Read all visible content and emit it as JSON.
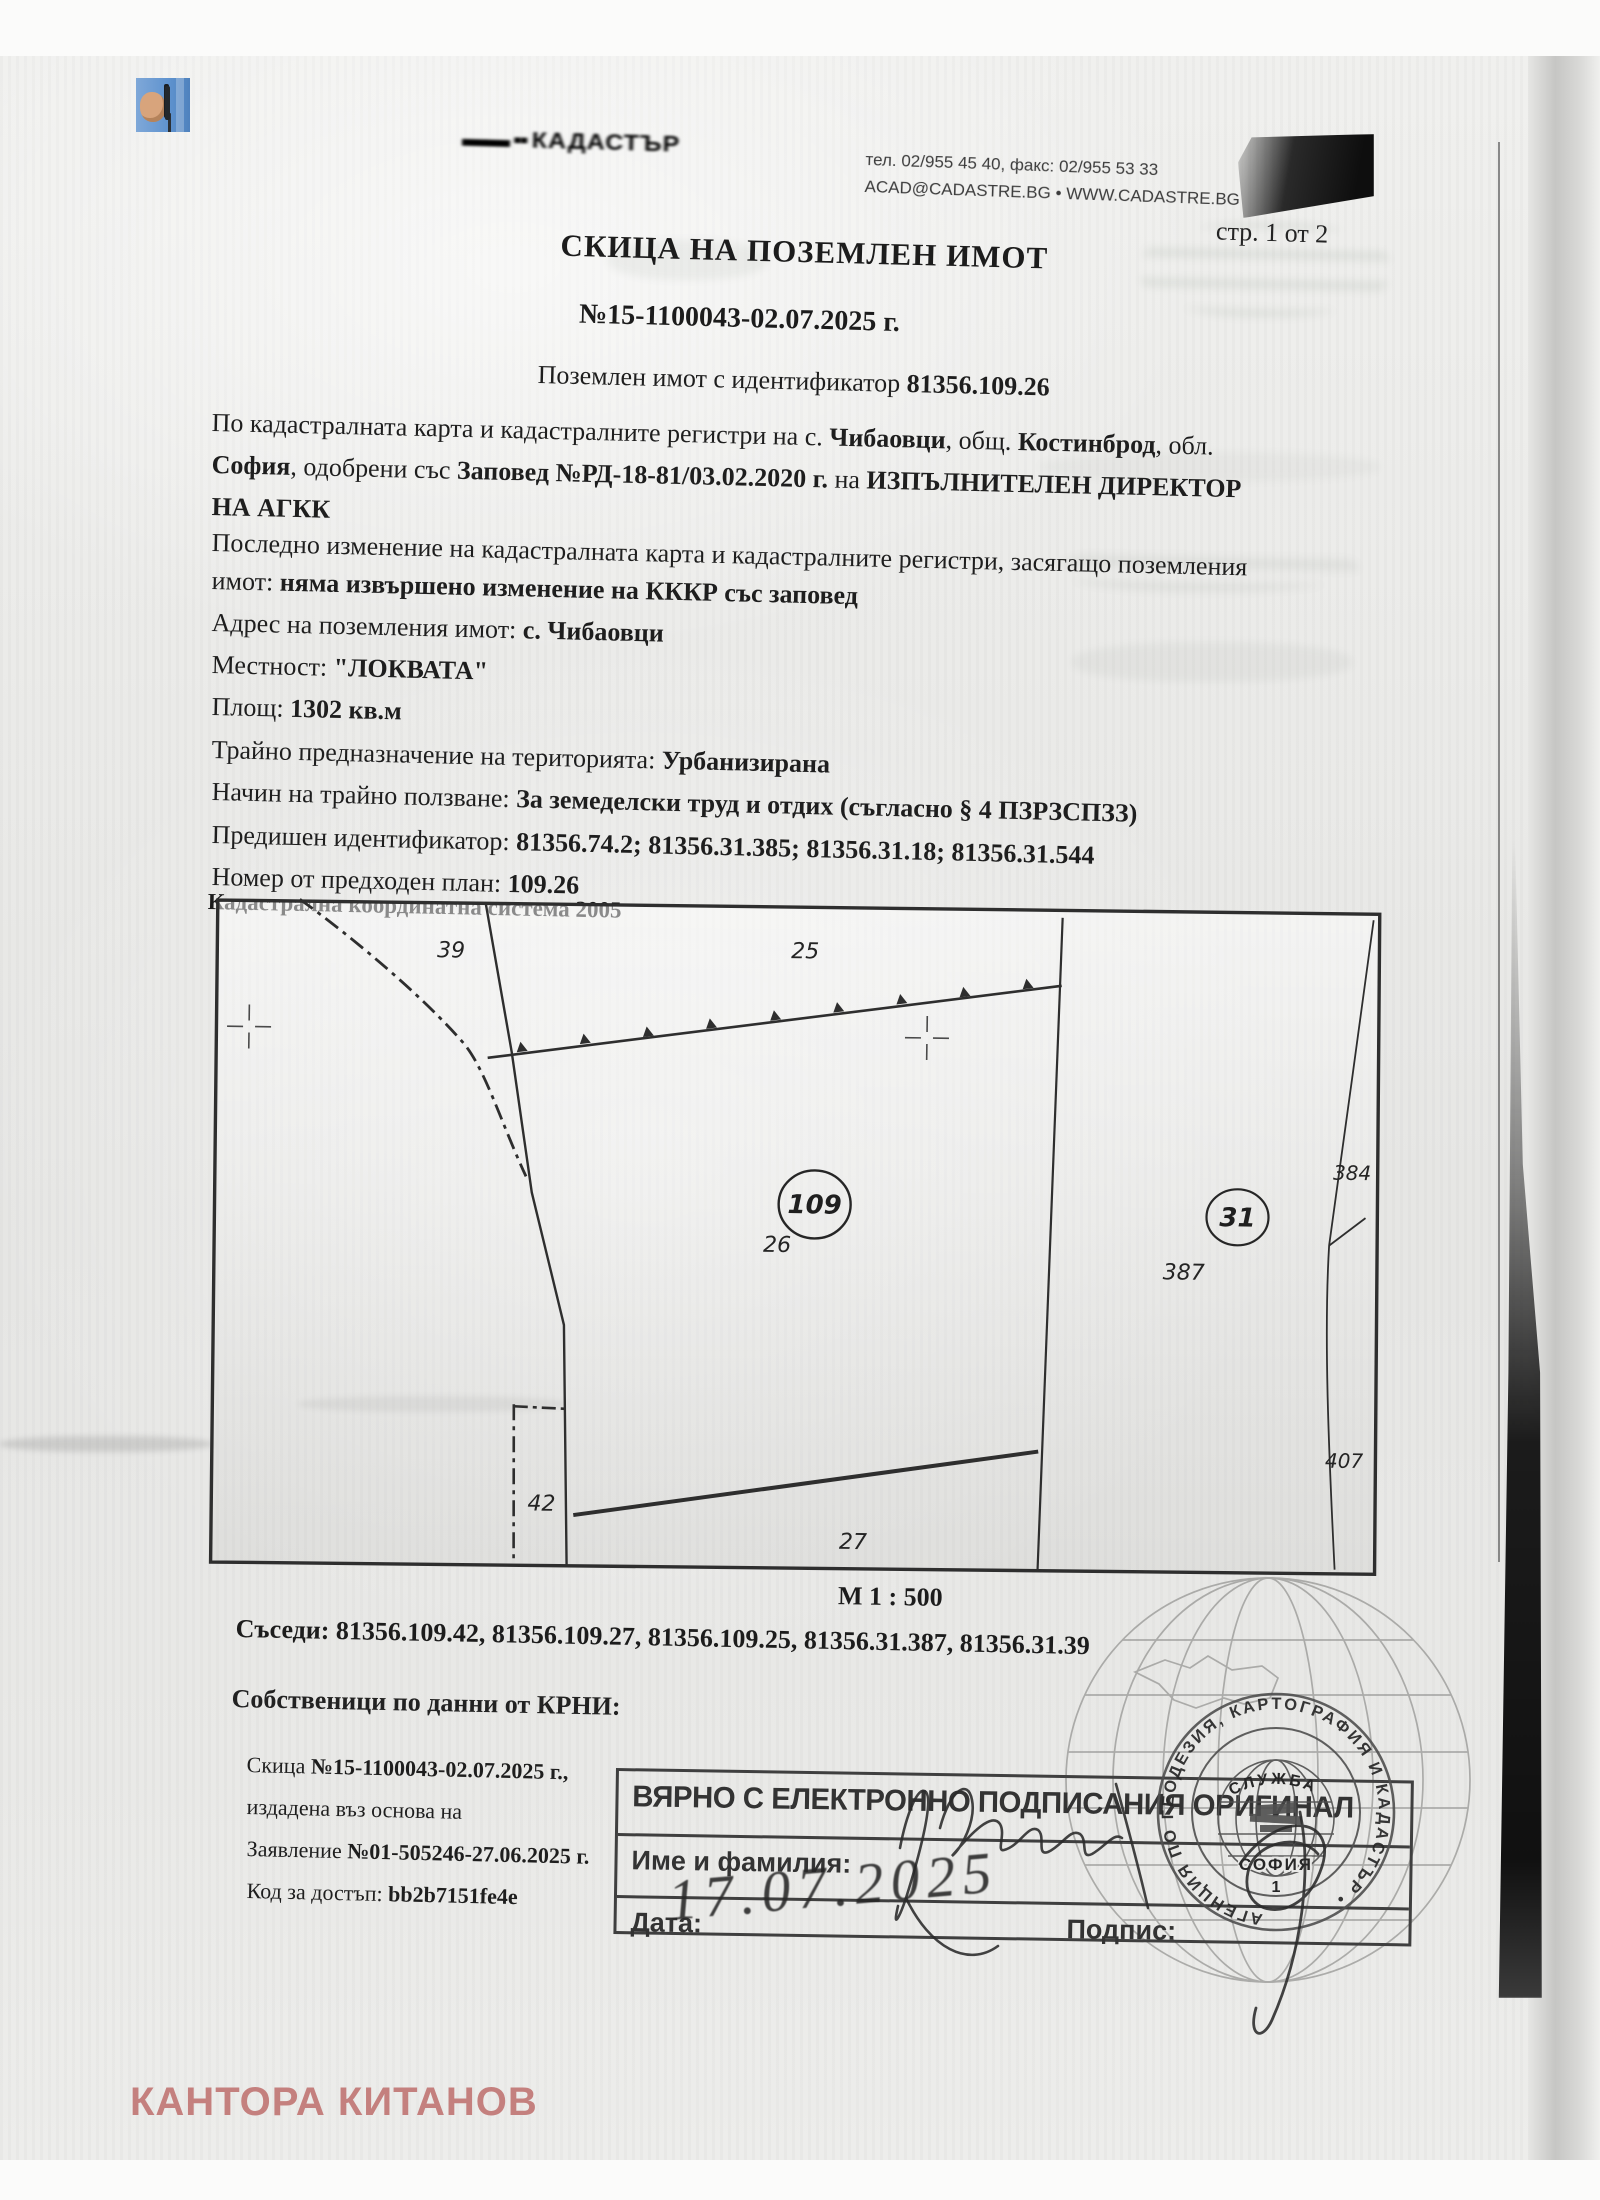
{
  "page": {
    "number_label": "стр. 1 от 2",
    "watermark": "КАНТОРА КИТАНОВ",
    "watermark_color": "#c4807e",
    "accent_ink": "#3f3f3f"
  },
  "header": {
    "smudge_text": "КАДАСТЪР",
    "phone_line": "тел. 02/955 45 40, факс: 02/955 53 33",
    "web_line": "ACAD@CADASTRE.BG • WWW.CADASTRE.BG"
  },
  "title": {
    "main": "СКИЦА НА ПОЗЕМЛЕН ИМОТ",
    "number": "№15-1100043-02.07.2025 г.",
    "id_prefix": "Поземлен имот с идентификатор ",
    "id_value": "81356.109.26"
  },
  "body": {
    "l1": [
      "По кадастралната карта и кадастралните регистри на с. ",
      "Чибаовци",
      ", общ. ",
      "Костинброд",
      ", обл."
    ],
    "l2": [
      "София",
      ", одобрени със ",
      "Заповед №РД-18-81/03.02.2020 г.",
      " на ",
      "ИЗПЪЛНИТЕЛЕН ДИРЕКТОР"
    ],
    "l3": "НА АГКК",
    "l4": "Последно изменение на кадастралната карта и кадастралните регистри, засягащо поземления",
    "l5": [
      "имот: ",
      "няма извършено изменение на КККР със заповед"
    ],
    "l6": [
      "Адрес на поземления имот: ",
      "с. Чибаовци"
    ],
    "l7": [
      "Местност: ",
      "\"ЛОКВАТА\""
    ],
    "l8": [
      "Площ: ",
      "1302 кв.м"
    ],
    "l9": [
      "Трайно предназначение на територията: ",
      "Урбанизирана"
    ],
    "l10": [
      "Начин на трайно ползване: ",
      "За земеделски труд и отдих (съгласно § 4 ПЗРЗСПЗЗ)"
    ],
    "l11": [
      "Предишен идентификатор: ",
      "81356.74.2; 81356.31.385; 81356.31.18; 81356.31.544"
    ],
    "l12": [
      "Номер от предходен план: ",
      "109.26"
    ],
    "coord_system": "Кадастрална координатна система 2005"
  },
  "map": {
    "scale": "М 1 : 500",
    "labels": {
      "p39": "39",
      "p25": "25",
      "p42": "42",
      "p27": "27",
      "p384": "384",
      "p387": "387",
      "p407": "407",
      "c109": "109",
      "c26": "26",
      "c31": "31"
    }
  },
  "neighbors": {
    "label": "Съседи: ",
    "list": "81356.109.42, 81356.109.27, 81356.109.25, 81356.31.387, 81356.31.39"
  },
  "owners": {
    "heading": "Собственици по данни от КРНИ:",
    "sketch_line": [
      "Скица ",
      "№15-1100043-02.07.2025 г.,"
    ],
    "issued_line": "издадена въз основа на",
    "application_line": [
      "Заявление ",
      "№01-505246-27.06.2025 г."
    ],
    "access_line": [
      "Код за достъп: ",
      "bb2b7151fe4e"
    ]
  },
  "attestation": {
    "title": "ВЯРНО С ЕЛЕКТРОННО ПОДПИСАНИЯ ОРИГИНАЛ",
    "name_label": "Име и фамилия:",
    "date_label": "Дата:",
    "date_value": "17.07.2025",
    "sign_label": "Подпис:"
  },
  "stamp": {
    "ring_text": "АГЕНЦИЯ ПО ГЕОДЕЗИЯ, КАРТОГРАФИЯ И КАДАСТЪР •",
    "inner_top": "СЛУЖБА",
    "inner_city": "СОФИЯ",
    "inner_num": "1"
  }
}
